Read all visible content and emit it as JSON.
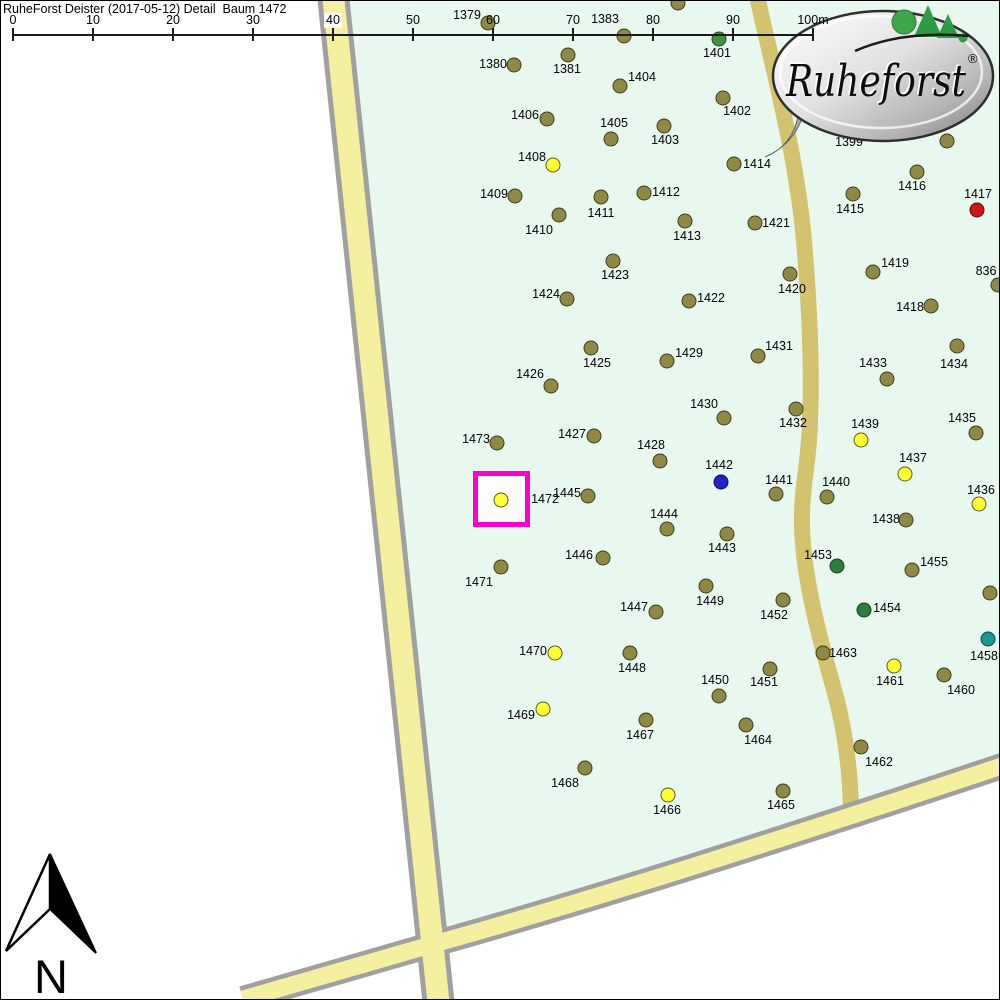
{
  "title": "RuheForst Deister (2017-05-12) Detail  Baum 1472",
  "selected_tree": "1472",
  "scale_bar": {
    "labels": [
      "0",
      "10",
      "20",
      "30",
      "40",
      "50",
      "60",
      "70",
      "80",
      "90",
      "100m"
    ],
    "x_start": 12,
    "spacing": 80,
    "line_y": 33,
    "label_y": 19,
    "tick_top": 27,
    "tick_height": 13,
    "highlighted_label_index": 4
  },
  "logo": {
    "brand": "Ruheforst",
    "registered": "®"
  },
  "north_arrow": {
    "label": "N"
  },
  "colors": {
    "forest": "#E9F8EE",
    "road_fill": "#F5EFA0",
    "road_border": "#A0A0A0",
    "track_fill": "#D5C26E",
    "highlight_box": "#FF00CC",
    "scale_ink": "#1a1a1a",
    "dot": {
      "olive": {
        "fill": "#8E8944",
        "stroke": "#3F3C16"
      },
      "yellow": {
        "fill": "#FFFF33",
        "stroke": "#5A5A20"
      },
      "green": {
        "fill": "#3F9242",
        "stroke": "#1E4A20"
      },
      "darkgreen": {
        "fill": "#2F7D3C",
        "stroke": "#16401C"
      },
      "teal": {
        "fill": "#1D9696",
        "stroke": "#0B4A4A"
      },
      "blue": {
        "fill": "#2222C8",
        "stroke": "#0A0A66"
      },
      "red": {
        "fill": "#D01616",
        "stroke": "#660808"
      }
    }
  },
  "highlight_box": {
    "x": 472,
    "y": 470,
    "w": 57,
    "h": 56,
    "border": 5
  },
  "trees": [
    {
      "id": "1379",
      "x": 487,
      "y": 22,
      "lx": 466,
      "ly": 14,
      "c": "olive"
    },
    {
      "id": "1383",
      "x": 623,
      "y": 35,
      "lx": 604,
      "ly": 18,
      "c": "olive"
    },
    {
      "id": "1401",
      "x": 718,
      "y": 38,
      "lx": 716,
      "ly": 52,
      "c": "green"
    },
    {
      "id": "1380",
      "x": 513,
      "y": 64,
      "lx": 492,
      "ly": 63,
      "c": "olive"
    },
    {
      "id": "1381",
      "x": 567,
      "y": 54,
      "lx": 566,
      "ly": 68,
      "c": "olive"
    },
    {
      "id": "1404",
      "x": 619,
      "y": 85,
      "lx": 641,
      "ly": 76,
      "c": "olive"
    },
    {
      "id": "1402",
      "x": 722,
      "y": 97,
      "lx": 736,
      "ly": 110,
      "c": "olive"
    },
    {
      "id": "1406",
      "x": 546,
      "y": 118,
      "lx": 524,
      "ly": 114,
      "c": "olive"
    },
    {
      "id": "1405",
      "x": 610,
      "y": 138,
      "lx": 613,
      "ly": 122,
      "c": "olive"
    },
    {
      "id": "1403",
      "x": 663,
      "y": 125,
      "lx": 664,
      "ly": 139,
      "c": "olive"
    },
    {
      "id": "1408",
      "x": 552,
      "y": 164,
      "lx": 531,
      "ly": 156,
      "c": "yellow"
    },
    {
      "id": "1414",
      "x": 733,
      "y": 163,
      "lx": 756,
      "ly": 163,
      "c": "olive"
    },
    {
      "id": "1416",
      "x": 916,
      "y": 171,
      "lx": 911,
      "ly": 185,
      "c": "olive"
    },
    {
      "id": "1415",
      "x": 852,
      "y": 193,
      "lx": 849,
      "ly": 208,
      "c": "olive"
    },
    {
      "id": "1417",
      "x": 976,
      "y": 209,
      "lx": 977,
      "ly": 193,
      "c": "red"
    },
    {
      "id": "1409",
      "x": 514,
      "y": 195,
      "lx": 493,
      "ly": 193,
      "c": "olive"
    },
    {
      "id": "1412",
      "x": 643,
      "y": 192,
      "lx": 665,
      "ly": 191,
      "c": "olive"
    },
    {
      "id": "1411",
      "x": 600,
      "y": 196,
      "lx": 600,
      "ly": 212,
      "c": "olive"
    },
    {
      "id": "1410",
      "x": 558,
      "y": 214,
      "lx": 538,
      "ly": 229,
      "c": "olive"
    },
    {
      "id": "1413",
      "x": 684,
      "y": 220,
      "lx": 686,
      "ly": 235,
      "c": "olive"
    },
    {
      "id": "1421",
      "x": 754,
      "y": 222,
      "lx": 775,
      "ly": 222,
      "c": "olive"
    },
    {
      "id": "1423",
      "x": 612,
      "y": 260,
      "lx": 614,
      "ly": 274,
      "c": "olive"
    },
    {
      "id": "1419",
      "x": 872,
      "y": 271,
      "lx": 894,
      "ly": 262,
      "c": "olive"
    },
    {
      "id": "836",
      "x": 997,
      "y": 284,
      "lx": 985,
      "ly": 270,
      "c": "olive"
    },
    {
      "id": "1424",
      "x": 566,
      "y": 298,
      "lx": 545,
      "ly": 293,
      "c": "olive"
    },
    {
      "id": "1422",
      "x": 688,
      "y": 300,
      "lx": 710,
      "ly": 297,
      "c": "olive"
    },
    {
      "id": "1420",
      "x": 789,
      "y": 273,
      "lx": 791,
      "ly": 288,
      "c": "olive"
    },
    {
      "id": "1418",
      "x": 930,
      "y": 305,
      "lx": 909,
      "ly": 306,
      "c": "olive"
    },
    {
      "id": "1434",
      "x": 956,
      "y": 345,
      "lx": 953,
      "ly": 363,
      "c": "olive"
    },
    {
      "id": "1433",
      "x": 886,
      "y": 378,
      "lx": 872,
      "ly": 362,
      "c": "olive"
    },
    {
      "id": "1425",
      "x": 590,
      "y": 347,
      "lx": 596,
      "ly": 362,
      "c": "olive"
    },
    {
      "id": "1429",
      "x": 666,
      "y": 360,
      "lx": 688,
      "ly": 352,
      "c": "olive"
    },
    {
      "id": "1431",
      "x": 757,
      "y": 355,
      "lx": 778,
      "ly": 345,
      "c": "olive"
    },
    {
      "id": "1426",
      "x": 550,
      "y": 385,
      "lx": 529,
      "ly": 373,
      "c": "olive"
    },
    {
      "id": "1430",
      "x": 723,
      "y": 417,
      "lx": 703,
      "ly": 403,
      "c": "olive"
    },
    {
      "id": "1432",
      "x": 795,
      "y": 408,
      "lx": 792,
      "ly": 422,
      "c": "olive"
    },
    {
      "id": "1435",
      "x": 975,
      "y": 432,
      "lx": 961,
      "ly": 417,
      "c": "olive"
    },
    {
      "id": "1439",
      "x": 860,
      "y": 439,
      "lx": 864,
      "ly": 423,
      "c": "yellow"
    },
    {
      "id": "1473",
      "x": 496,
      "y": 442,
      "lx": 475,
      "ly": 438,
      "c": "olive"
    },
    {
      "id": "1427",
      "x": 593,
      "y": 435,
      "lx": 571,
      "ly": 433,
      "c": "olive"
    },
    {
      "id": "1428",
      "x": 659,
      "y": 460,
      "lx": 650,
      "ly": 444,
      "c": "olive"
    },
    {
      "id": "1437",
      "x": 904,
      "y": 473,
      "lx": 912,
      "ly": 457,
      "c": "yellow"
    },
    {
      "id": "1442",
      "x": 720,
      "y": 481,
      "lx": 718,
      "ly": 464,
      "c": "blue"
    },
    {
      "id": "1441",
      "x": 775,
      "y": 493,
      "lx": 778,
      "ly": 479,
      "c": "olive"
    },
    {
      "id": "1440",
      "x": 826,
      "y": 496,
      "lx": 835,
      "ly": 481,
      "c": "olive"
    },
    {
      "id": "1436",
      "x": 978,
      "y": 503,
      "lx": 980,
      "ly": 489,
      "c": "yellow"
    },
    {
      "id": "1472",
      "x": 500,
      "y": 499,
      "lx": 544,
      "ly": 498,
      "c": "yellow"
    },
    {
      "id": "1445",
      "x": 587,
      "y": 495,
      "lx": 566,
      "ly": 492,
      "c": "olive"
    },
    {
      "id": "1444",
      "x": 666,
      "y": 528,
      "lx": 663,
      "ly": 513,
      "c": "olive"
    },
    {
      "id": "1443",
      "x": 726,
      "y": 533,
      "lx": 721,
      "ly": 547,
      "c": "olive"
    },
    {
      "id": "1438",
      "x": 905,
      "y": 519,
      "lx": 885,
      "ly": 518,
      "c": "olive"
    },
    {
      "id": "1446",
      "x": 602,
      "y": 557,
      "lx": 578,
      "ly": 554,
      "c": "olive"
    },
    {
      "id": "1453",
      "x": 836,
      "y": 565,
      "lx": 817,
      "ly": 554,
      "c": "darkgreen"
    },
    {
      "id": "1455",
      "x": 911,
      "y": 569,
      "lx": 933,
      "ly": 561,
      "c": "olive"
    },
    {
      "id": "1471",
      "x": 500,
      "y": 566,
      "lx": 478,
      "ly": 581,
      "c": "olive"
    },
    {
      "id": "1454",
      "x": 863,
      "y": 609,
      "lx": 886,
      "ly": 607,
      "c": "darkgreen"
    },
    {
      "id": "1449",
      "x": 705,
      "y": 585,
      "lx": 709,
      "ly": 600,
      "c": "olive"
    },
    {
      "id": "1447",
      "x": 655,
      "y": 611,
      "lx": 633,
      "ly": 606,
      "c": "olive"
    },
    {
      "id": "1452",
      "x": 782,
      "y": 599,
      "lx": 773,
      "ly": 614,
      "c": "olive"
    },
    {
      "id": "1458",
      "x": 987,
      "y": 638,
      "lx": 983,
      "ly": 655,
      "c": "teal"
    },
    {
      "id": "1463",
      "x": 822,
      "y": 652,
      "lx": 842,
      "ly": 652,
      "c": "olive"
    },
    {
      "id": "1470",
      "x": 554,
      "y": 652,
      "lx": 532,
      "ly": 650,
      "c": "yellow"
    },
    {
      "id": "1448",
      "x": 629,
      "y": 652,
      "lx": 631,
      "ly": 667,
      "c": "olive"
    },
    {
      "id": "1451",
      "x": 769,
      "y": 668,
      "lx": 763,
      "ly": 681,
      "c": "olive"
    },
    {
      "id": "1450",
      "x": 718,
      "y": 695,
      "lx": 714,
      "ly": 679,
      "c": "olive"
    },
    {
      "id": "1461",
      "x": 893,
      "y": 665,
      "lx": 889,
      "ly": 680,
      "c": "yellow"
    },
    {
      "id": "1460",
      "x": 943,
      "y": 674,
      "lx": 960,
      "ly": 689,
      "c": "olive"
    },
    {
      "id": "1469",
      "x": 542,
      "y": 708,
      "lx": 520,
      "ly": 714,
      "c": "yellow"
    },
    {
      "id": "1467",
      "x": 645,
      "y": 719,
      "lx": 639,
      "ly": 734,
      "c": "olive"
    },
    {
      "id": "1464",
      "x": 745,
      "y": 724,
      "lx": 757,
      "ly": 739,
      "c": "olive"
    },
    {
      "id": "1462",
      "x": 860,
      "y": 746,
      "lx": 878,
      "ly": 761,
      "c": "olive"
    },
    {
      "id": "1468",
      "x": 584,
      "y": 767,
      "lx": 564,
      "ly": 782,
      "c": "olive"
    },
    {
      "id": "1466",
      "x": 667,
      "y": 794,
      "lx": 666,
      "ly": 809,
      "c": "yellow"
    },
    {
      "id": "1465",
      "x": 782,
      "y": 790,
      "lx": 780,
      "ly": 804,
      "c": "olive"
    }
  ],
  "unlabeled_dots": [
    {
      "x": 677,
      "y": 2,
      "c": "olive"
    },
    {
      "x": 946,
      "y": 140,
      "c": "olive"
    },
    {
      "x": 989,
      "y": 592,
      "c": "olive"
    }
  ],
  "partial_labels": [
    {
      "text": "1399",
      "x": 848,
      "y": 141
    }
  ]
}
